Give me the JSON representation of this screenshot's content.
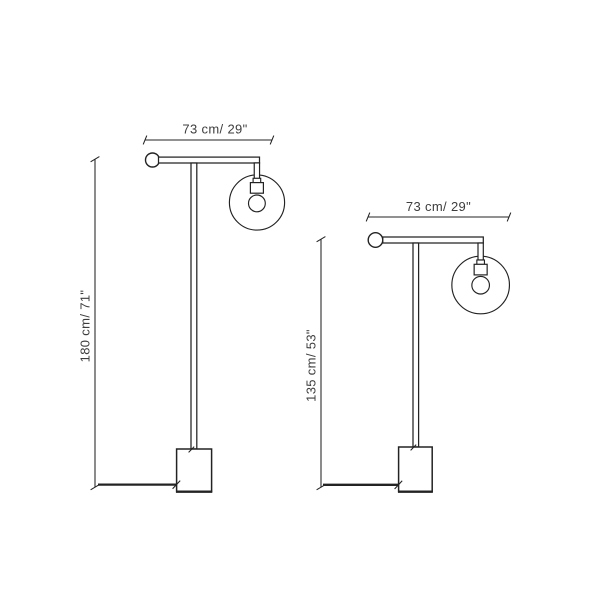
{
  "page": {
    "background": "#ffffff"
  },
  "diagram": {
    "type": "product-dimension-drawing",
    "subject": "floor lamp with globe pendant, two sizes",
    "line_color": "#232323",
    "text_color": "#3d3d3d",
    "lamps": [
      {
        "name": "floor-lamp-large",
        "width_label": "73 cm/ 29\"",
        "height_label": "180 cm/ 71\"",
        "width_cm": 73,
        "width_in": 29,
        "height_cm": 180,
        "height_in": 71
      },
      {
        "name": "floor-lamp-small",
        "width_label": "73 cm/ 29\"",
        "height_label": "135 cm/ 53\"",
        "width_cm": 73,
        "width_in": 29,
        "height_cm": 135,
        "height_in": 53
      }
    ]
  }
}
